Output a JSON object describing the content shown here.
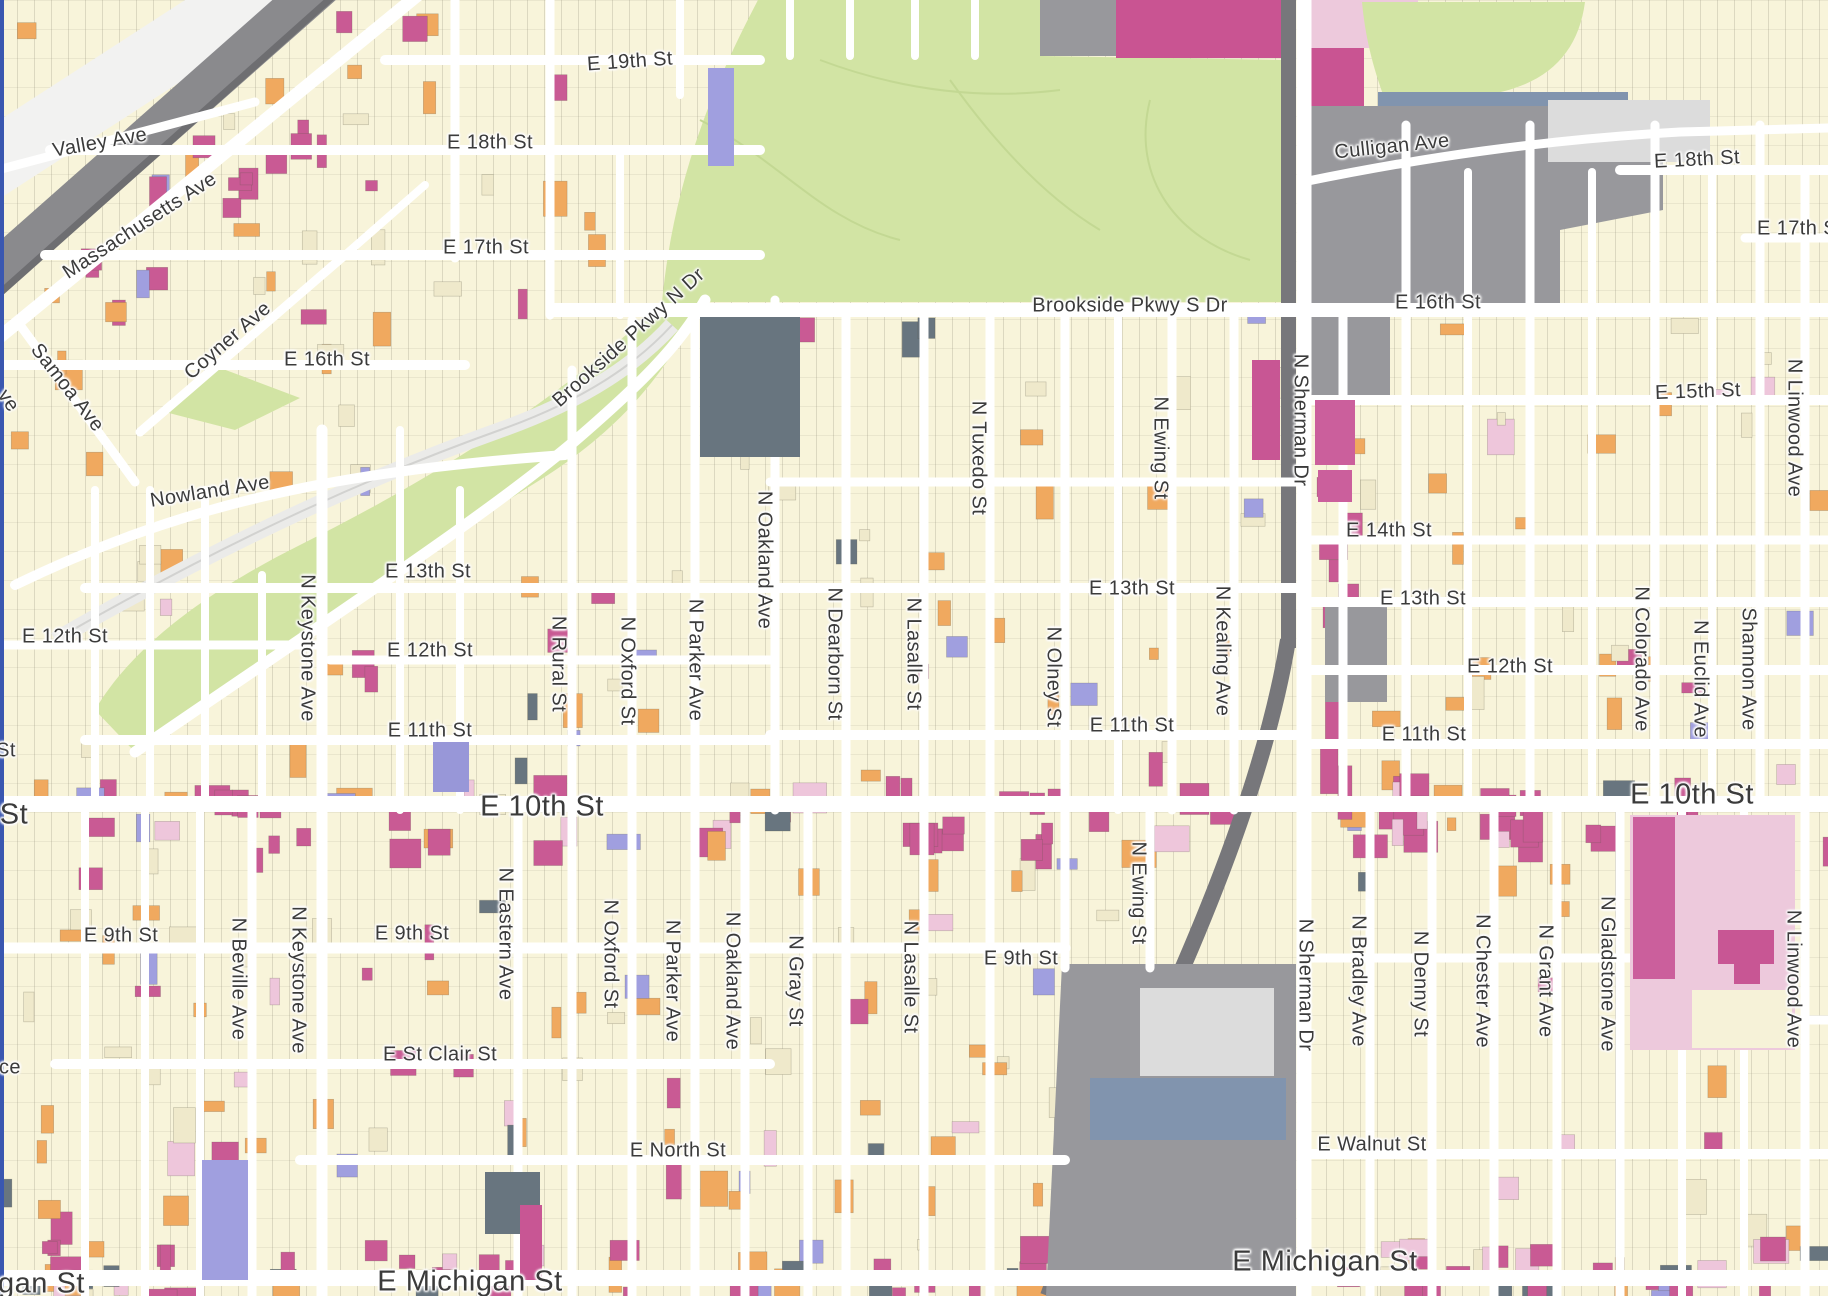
{
  "map": {
    "type": "city-parcel-map",
    "area": "Indianapolis near-east side",
    "colors": {
      "road": "#ffffff",
      "parcel_base": "#f8f4da",
      "parcel_cream": "#efe9cb",
      "parcel_orange": "#f0a95f",
      "parcel_magenta": "#c95a94",
      "parcel_light_pink": "#eec6db",
      "parcel_periwinkle": "#a09fdf",
      "parcel_slate": "#68757f",
      "park_green": "#d2e4a4",
      "industrial_gray": "#98989c",
      "railroad_gray": "#77777b",
      "steel_blue": "#8194ae",
      "label_text": "#3b3b3b",
      "map_edge_blue": "#3a57b0"
    },
    "labels": [
      {
        "text": "Valley Ave",
        "x": 100,
        "y": 143,
        "rot": -10,
        "size": "normal"
      },
      {
        "text": "Massachusetts Ave",
        "x": 140,
        "y": 226,
        "rot": -33,
        "size": "normal"
      },
      {
        "text": "Samoa Ave",
        "x": 67,
        "y": 388,
        "rot": 52,
        "size": "normal"
      },
      {
        "text": "ve",
        "x": 8,
        "y": 401,
        "rot": 55,
        "size": "normal"
      },
      {
        "text": "Coyner Ave",
        "x": 228,
        "y": 341,
        "rot": -41,
        "size": "normal"
      },
      {
        "text": "E 19th St",
        "x": 630,
        "y": 62,
        "rot": -4,
        "size": "normal"
      },
      {
        "text": "E 18th St",
        "x": 490,
        "y": 143,
        "rot": 0,
        "size": "normal"
      },
      {
        "text": "E 17th St",
        "x": 486,
        "y": 248,
        "rot": 0,
        "size": "normal"
      },
      {
        "text": "E 16th St",
        "x": 327,
        "y": 360,
        "rot": 0,
        "size": "normal"
      },
      {
        "text": "Brookside Pkwy N Dr",
        "x": 629,
        "y": 338,
        "rot": -42,
        "size": "normal"
      },
      {
        "text": "Nowland Ave",
        "x": 210,
        "y": 492,
        "rot": -9,
        "size": "normal"
      },
      {
        "text": "Brookside Pkwy S Dr",
        "x": 1130,
        "y": 306,
        "rot": 0,
        "size": "normal"
      },
      {
        "text": "E 16th St",
        "x": 1438,
        "y": 303,
        "rot": 0,
        "size": "normal"
      },
      {
        "text": "Culligan Ave",
        "x": 1392,
        "y": 147,
        "rot": -6,
        "size": "normal"
      },
      {
        "text": "E 18th St",
        "x": 1697,
        "y": 160,
        "rot": -3,
        "size": "normal"
      },
      {
        "text": "E 17th St",
        "x": 1800,
        "y": 229,
        "rot": 0,
        "size": "normal"
      },
      {
        "text": "E 15th St",
        "x": 1698,
        "y": 392,
        "rot": -2,
        "size": "normal"
      },
      {
        "text": "N Linwood Ave",
        "x": 1794,
        "y": 428,
        "rot": 90,
        "size": "normal"
      },
      {
        "text": "E 14th St",
        "x": 1389,
        "y": 531,
        "rot": 0,
        "size": "normal"
      },
      {
        "text": "E 13th St",
        "x": 428,
        "y": 572,
        "rot": 0,
        "size": "normal"
      },
      {
        "text": "E 13th St",
        "x": 1132,
        "y": 589,
        "rot": 0,
        "size": "normal"
      },
      {
        "text": "E 13th St",
        "x": 1423,
        "y": 599,
        "rot": 0,
        "size": "normal"
      },
      {
        "text": "E 12th St",
        "x": 65,
        "y": 637,
        "rot": 0,
        "size": "normal"
      },
      {
        "text": "E 12th St",
        "x": 430,
        "y": 651,
        "rot": 0,
        "size": "normal"
      },
      {
        "text": "E 12th St",
        "x": 1510,
        "y": 667,
        "rot": 0,
        "size": "normal"
      },
      {
        "text": "N Keystone Ave",
        "x": 307,
        "y": 648,
        "rot": 90,
        "size": "normal"
      },
      {
        "text": "N Rural St",
        "x": 558,
        "y": 664,
        "rot": 90,
        "size": "normal"
      },
      {
        "text": "N Oxford St",
        "x": 627,
        "y": 671,
        "rot": 90,
        "size": "normal"
      },
      {
        "text": "N Parker Ave",
        "x": 695,
        "y": 660,
        "rot": 90,
        "size": "normal"
      },
      {
        "text": "N Oakland Ave",
        "x": 764,
        "y": 560,
        "rot": 90,
        "size": "normal"
      },
      {
        "text": "N Dearborn St",
        "x": 834,
        "y": 654,
        "rot": 90,
        "size": "normal"
      },
      {
        "text": "N Lasalle St",
        "x": 913,
        "y": 654,
        "rot": 90,
        "size": "normal"
      },
      {
        "text": "N Tuxedo St",
        "x": 978,
        "y": 458,
        "rot": 90,
        "size": "normal"
      },
      {
        "text": "N Olney St",
        "x": 1053,
        "y": 677,
        "rot": 90,
        "size": "normal"
      },
      {
        "text": "N Ewing St",
        "x": 1160,
        "y": 448,
        "rot": 90,
        "size": "normal"
      },
      {
        "text": "N Kealing Ave",
        "x": 1222,
        "y": 651,
        "rot": 90,
        "size": "normal"
      },
      {
        "text": "N Sherman Dr",
        "x": 1300,
        "y": 420,
        "rot": 90,
        "size": "normal"
      },
      {
        "text": "E 11th St",
        "x": 430,
        "y": 731,
        "rot": 0,
        "size": "normal"
      },
      {
        "text": "E 11th St",
        "x": 1132,
        "y": 726,
        "rot": 0,
        "size": "normal"
      },
      {
        "text": "E 11th St",
        "x": 1424,
        "y": 735,
        "rot": 0,
        "size": "normal"
      },
      {
        "text": "St",
        "x": 6,
        "y": 751,
        "rot": 0,
        "size": "normal"
      },
      {
        "text": "St",
        "x": 14,
        "y": 815,
        "rot": 0,
        "size": "major"
      },
      {
        "text": "E 10th St",
        "x": 542,
        "y": 807,
        "rot": 0,
        "size": "major"
      },
      {
        "text": "E 10th St",
        "x": 1692,
        "y": 795,
        "rot": 0,
        "size": "major"
      },
      {
        "text": "E 9th St",
        "x": 121,
        "y": 936,
        "rot": 0,
        "size": "normal"
      },
      {
        "text": "E 9th St",
        "x": 412,
        "y": 934,
        "rot": 0,
        "size": "normal"
      },
      {
        "text": "E 9th St",
        "x": 1021,
        "y": 959,
        "rot": 0,
        "size": "normal"
      },
      {
        "text": "N Beville Ave",
        "x": 238,
        "y": 979,
        "rot": 90,
        "size": "normal"
      },
      {
        "text": "N Keystone Ave",
        "x": 298,
        "y": 980,
        "rot": 90,
        "size": "normal"
      },
      {
        "text": "N Eastern Ave",
        "x": 505,
        "y": 934,
        "rot": 90,
        "size": "normal"
      },
      {
        "text": "N Oxford St",
        "x": 610,
        "y": 954,
        "rot": 90,
        "size": "normal"
      },
      {
        "text": "N Parker Ave",
        "x": 672,
        "y": 981,
        "rot": 90,
        "size": "normal"
      },
      {
        "text": "N Oakland Ave",
        "x": 732,
        "y": 981,
        "rot": 90,
        "size": "normal"
      },
      {
        "text": "N Gray St",
        "x": 795,
        "y": 981,
        "rot": 90,
        "size": "normal"
      },
      {
        "text": "N Lasalle St",
        "x": 910,
        "y": 977,
        "rot": 90,
        "size": "normal"
      },
      {
        "text": "N Ewing St",
        "x": 1138,
        "y": 893,
        "rot": 90,
        "size": "normal"
      },
      {
        "text": "N Sherman Dr",
        "x": 1305,
        "y": 985,
        "rot": 90,
        "size": "normal"
      },
      {
        "text": "N Bradley Ave",
        "x": 1358,
        "y": 981,
        "rot": 90,
        "size": "normal"
      },
      {
        "text": "N Denny St",
        "x": 1420,
        "y": 984,
        "rot": 90,
        "size": "normal"
      },
      {
        "text": "N Chester Ave",
        "x": 1482,
        "y": 981,
        "rot": 90,
        "size": "normal"
      },
      {
        "text": "N Grant Ave",
        "x": 1545,
        "y": 981,
        "rot": 90,
        "size": "normal"
      },
      {
        "text": "N Gladstone Ave",
        "x": 1607,
        "y": 974,
        "rot": 90,
        "size": "normal"
      },
      {
        "text": "N Linwood Ave",
        "x": 1793,
        "y": 979,
        "rot": 90,
        "size": "normal"
      },
      {
        "text": "N Colorado Ave",
        "x": 1641,
        "y": 659,
        "rot": 90,
        "size": "normal"
      },
      {
        "text": "N Euclid Ave",
        "x": 1700,
        "y": 679,
        "rot": 90,
        "size": "normal"
      },
      {
        "text": "Shannon Ave",
        "x": 1748,
        "y": 669,
        "rot": 90,
        "size": "normal"
      },
      {
        "text": "ce",
        "x": 10,
        "y": 1068,
        "rot": 0,
        "size": "normal"
      },
      {
        "text": "E St Clair St",
        "x": 440,
        "y": 1055,
        "rot": 0,
        "size": "normal"
      },
      {
        "text": "E North St",
        "x": 678,
        "y": 1151,
        "rot": 0,
        "size": "normal"
      },
      {
        "text": "E Walnut St",
        "x": 1372,
        "y": 1145,
        "rot": 0,
        "size": "normal"
      },
      {
        "text": "igan St",
        "x": 38,
        "y": 1284,
        "rot": 0,
        "size": "major"
      },
      {
        "text": "E Michigan St",
        "x": 470,
        "y": 1282,
        "rot": 0,
        "size": "major"
      },
      {
        "text": "E Michigan St",
        "x": 1325,
        "y": 1262,
        "rot": 0,
        "size": "major"
      }
    ]
  }
}
